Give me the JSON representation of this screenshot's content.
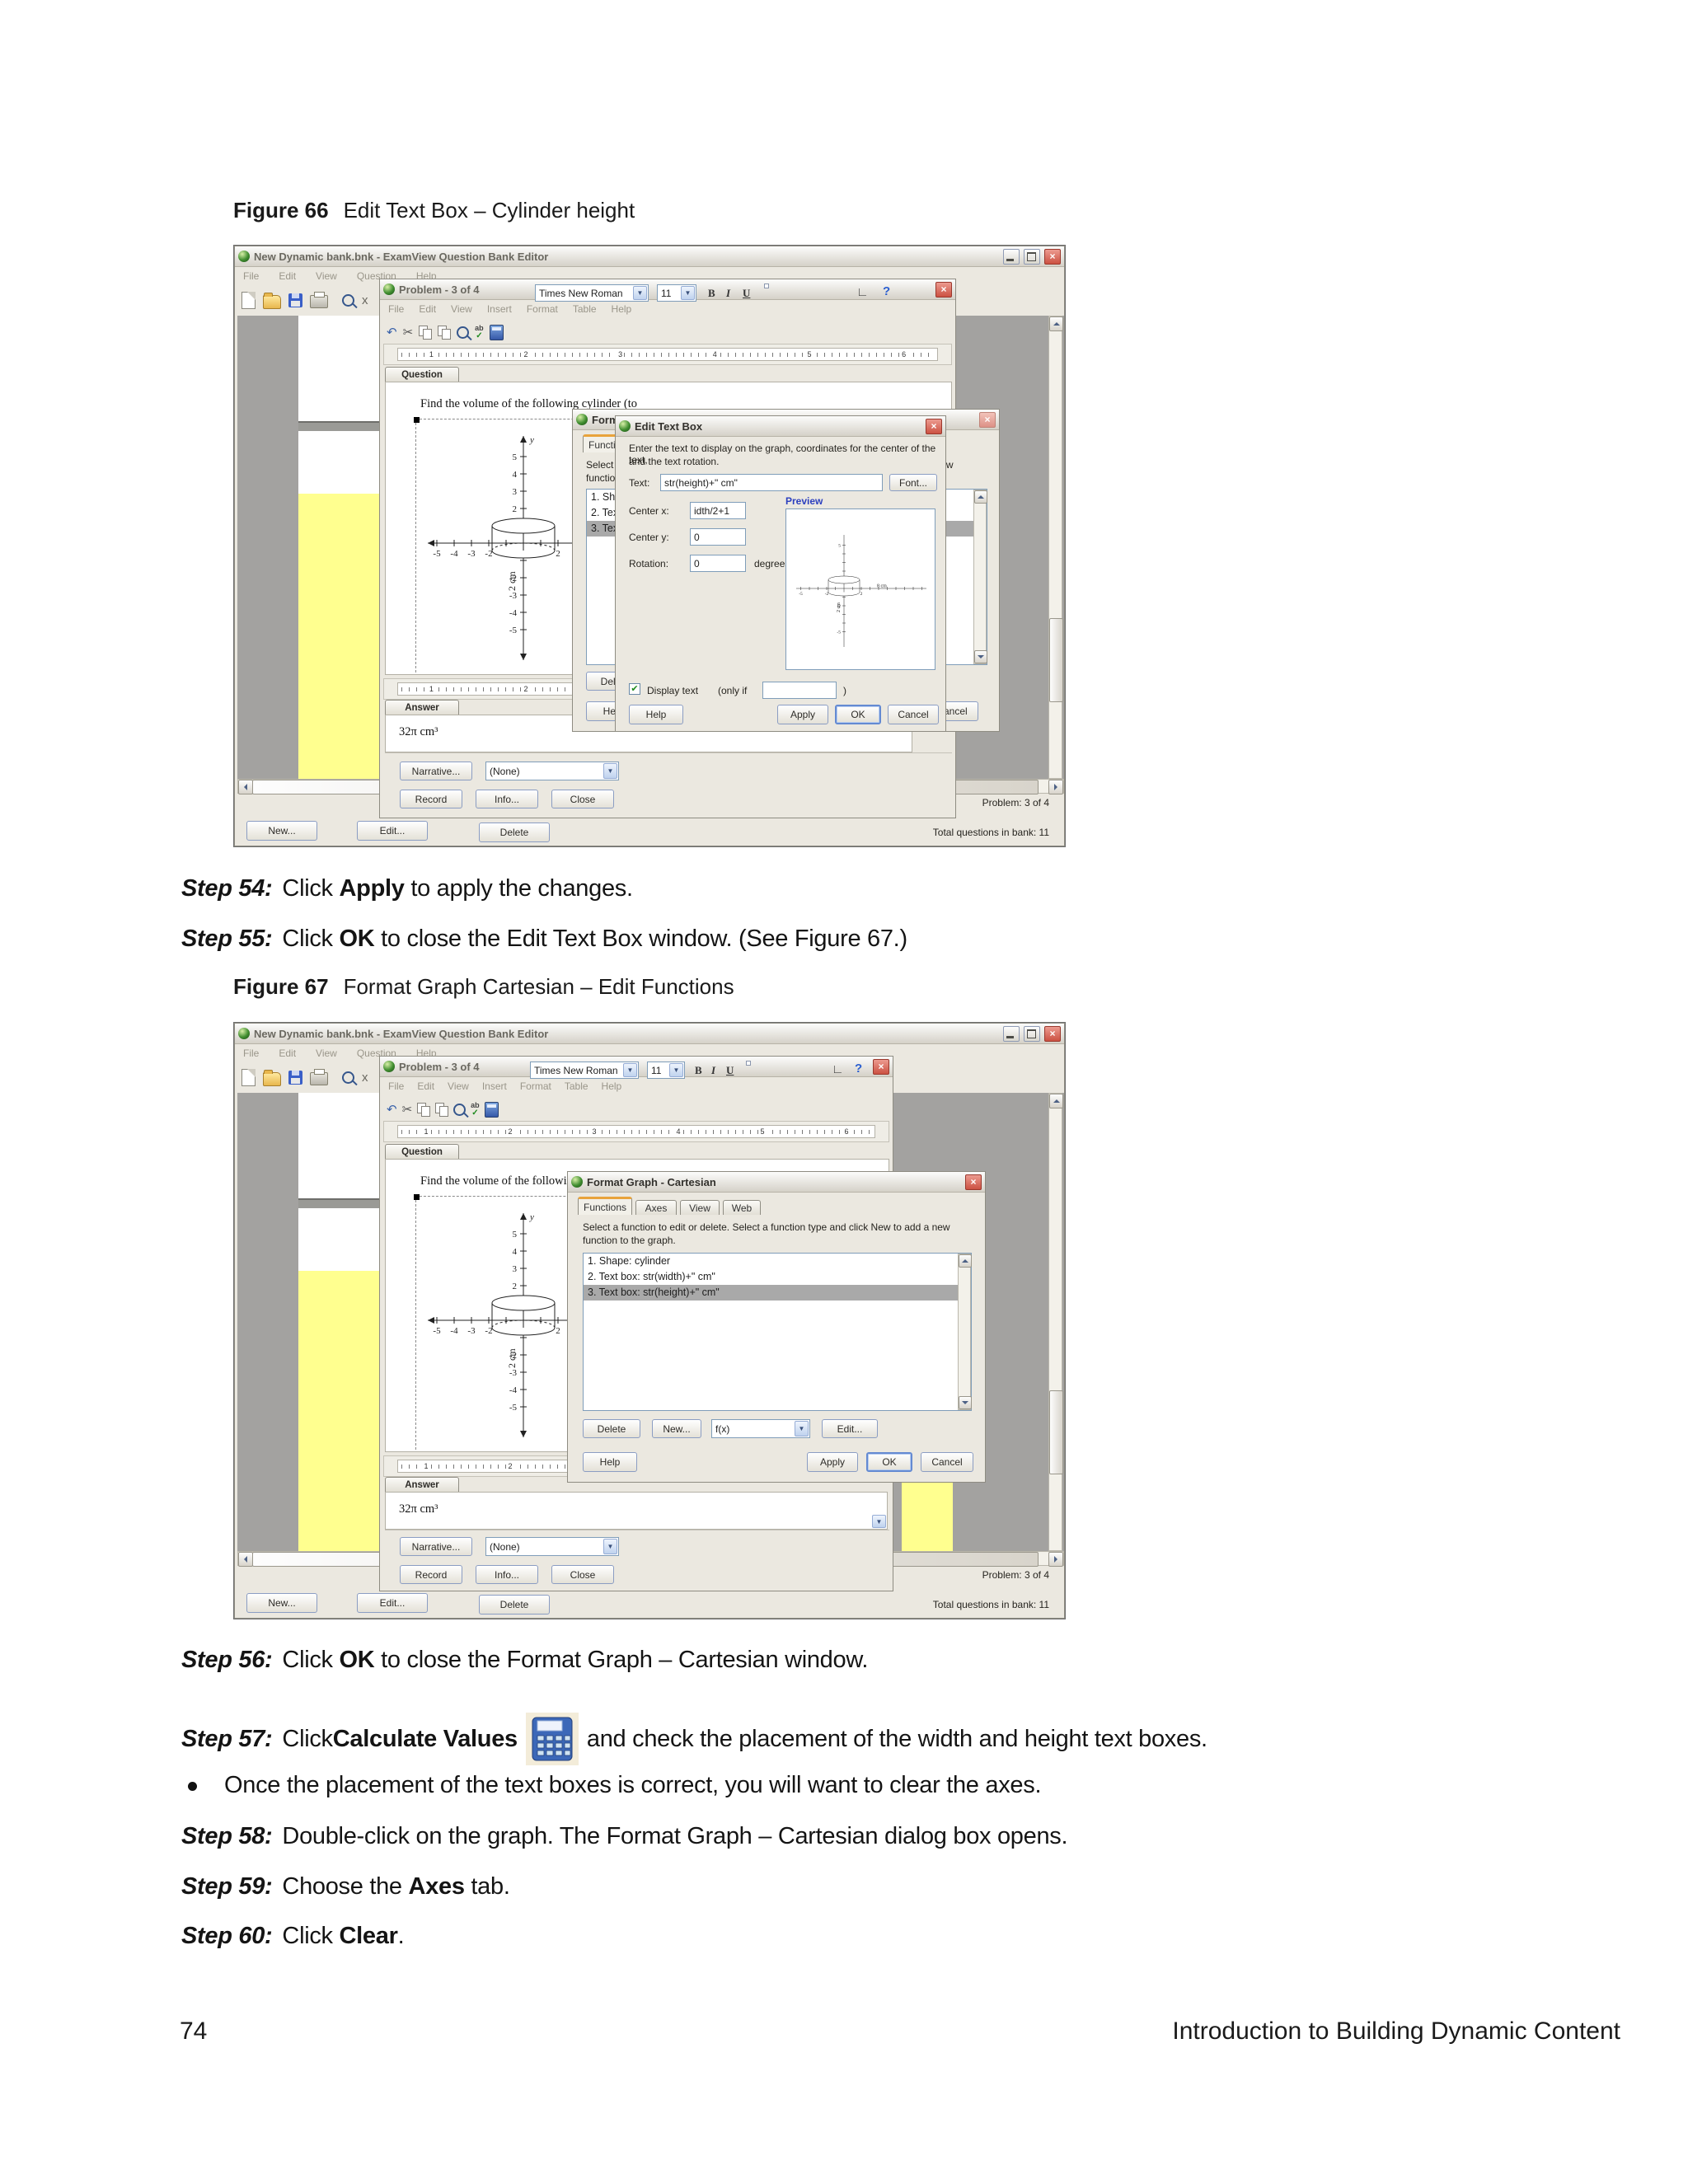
{
  "doc": {
    "fig66_label": "Figure 66",
    "fig66_title": "Edit Text Box – Cylinder height",
    "fig67_label": "Figure 67",
    "fig67_title": "Format Graph Cartesian – Edit Functions",
    "s54_label": "Step 54:",
    "s54_a": "Click ",
    "s54_b": "Apply",
    "s54_c": " to apply the changes.",
    "s55_label": "Step 55:",
    "s55_a": "Click ",
    "s55_b": "OK",
    "s55_c": " to close the Edit Text Box window. (See Figure 67.)",
    "s56_label": "Step 56:",
    "s56_a": "Click ",
    "s56_b": "OK",
    "s56_c": " to close the Format Graph – Cartesian window.",
    "s57_label": "Step 57:",
    "s57_a": "Click ",
    "s57_b": "Calculate Values",
    "s57_c": " and check the placement of the width and height text boxes.",
    "bullet1": "Once the placement of the text boxes is correct, you will want to clear the axes.",
    "s58_label": "Step 58:",
    "s58_a": "Double-click on the graph. The Format Graph – Cartesian dialog box opens.",
    "s59_label": "Step 59:",
    "s59_a": "Choose the ",
    "s59_b": "Axes",
    "s59_c": " tab.",
    "s60_label": "Step 60:",
    "s60_a": "Click ",
    "s60_b": "Clear",
    "s60_c": ".",
    "footer_left": "74",
    "footer_right": "Introduction to Building Dynamic Content"
  },
  "ed": {
    "title": "New Dynamic bank.bnk - ExamView Question Bank Editor",
    "menus": [
      "File",
      "Edit",
      "View",
      "Question",
      "Help"
    ],
    "new_btn": "New...",
    "edit_btn": "Edit...",
    "delete_btn": "Delete",
    "status_problem": "Problem: 3 of 4",
    "status_total": "Total questions in bank: 11"
  },
  "pw": {
    "title": "Problem - 3 of 4",
    "menus": [
      "File",
      "Edit",
      "View",
      "Insert",
      "Format",
      "Table",
      "Help"
    ],
    "font_name": "Times New Roman",
    "font_size": "11",
    "bold": "B",
    "italic": "I",
    "underline": "U",
    "help_q": "?",
    "question_tab": "Question",
    "answer_tab": "Answer",
    "question_text": "Find the volume of the following cylinder (to",
    "answer_text": "32π cm³",
    "narrative_btn": "Narrative...",
    "narrative_val": "(None)",
    "record_btn": "Record",
    "info_btn": "Info...",
    "close_btn": "Close",
    "ruler": [
      "1",
      "2",
      "3",
      "4",
      "5",
      "6"
    ]
  },
  "graph": {
    "x_neg": [
      "-5",
      "-4",
      "-3",
      "-2"
    ],
    "x_pos": [
      "2",
      "3"
    ],
    "y_pos": [
      "5",
      "4",
      "3",
      "2"
    ],
    "y_neg": [
      "-2",
      "-3",
      "-4",
      "-5"
    ],
    "width_label": "8 cm",
    "height_label": "2 cm",
    "axis_y": "y"
  },
  "etb": {
    "title": "Edit Text Box",
    "instr1": "Enter the text to display on the graph, coordinates for the center of the text,",
    "instr2": "and the text rotation.",
    "text_label": "Text:",
    "text_value": "str(height)+\" cm\"",
    "font_btn": "Font...",
    "cx_label": "Center x:",
    "cx_value": "idth/2+1",
    "cy_label": "Center y:",
    "cy_value": "0",
    "rot_label": "Rotation:",
    "rot_value": "0",
    "degrees": "degrees",
    "preview": "Preview",
    "display_text": "Display text",
    "only_if": "(only if",
    "paren": ")",
    "help": "Help",
    "apply": "Apply",
    "ok": "OK",
    "cancel": "Cancel"
  },
  "fg": {
    "title": "Format Graph - Cartesian",
    "tabs": [
      "Functions",
      "Axes",
      "View",
      "Web"
    ],
    "instr1": "Select a function to edit or delete.  Select a function type and click New to add a new",
    "instr2": "function to the graph.",
    "items": [
      "1. Shape: cylinder",
      "2. Text box: str(width)+\" cm\"",
      "3. Text box: str(height)+\" cm\""
    ],
    "delete_btn": "Delete",
    "new_btn": "New...",
    "fx": "f(x)",
    "edit_btn": "Edit...",
    "help": "Help",
    "apply": "Apply",
    "ok": "OK",
    "cancel": "Cancel"
  },
  "icons": {
    "close": "×",
    "check": "✔",
    "arrow_down": "▼",
    "undo": "↶",
    "scissors": "✂",
    "angle": "∟",
    "spell_ab": "ab",
    "spell_ok": "✓"
  },
  "colors": {
    "highlight_yellow": "#ffff8f",
    "workspace_gray": "#a3a2a0",
    "close_red": "#cc5142",
    "tab_accent_orange": "#e8a33b",
    "preview_blue": "#2b3fbf"
  }
}
